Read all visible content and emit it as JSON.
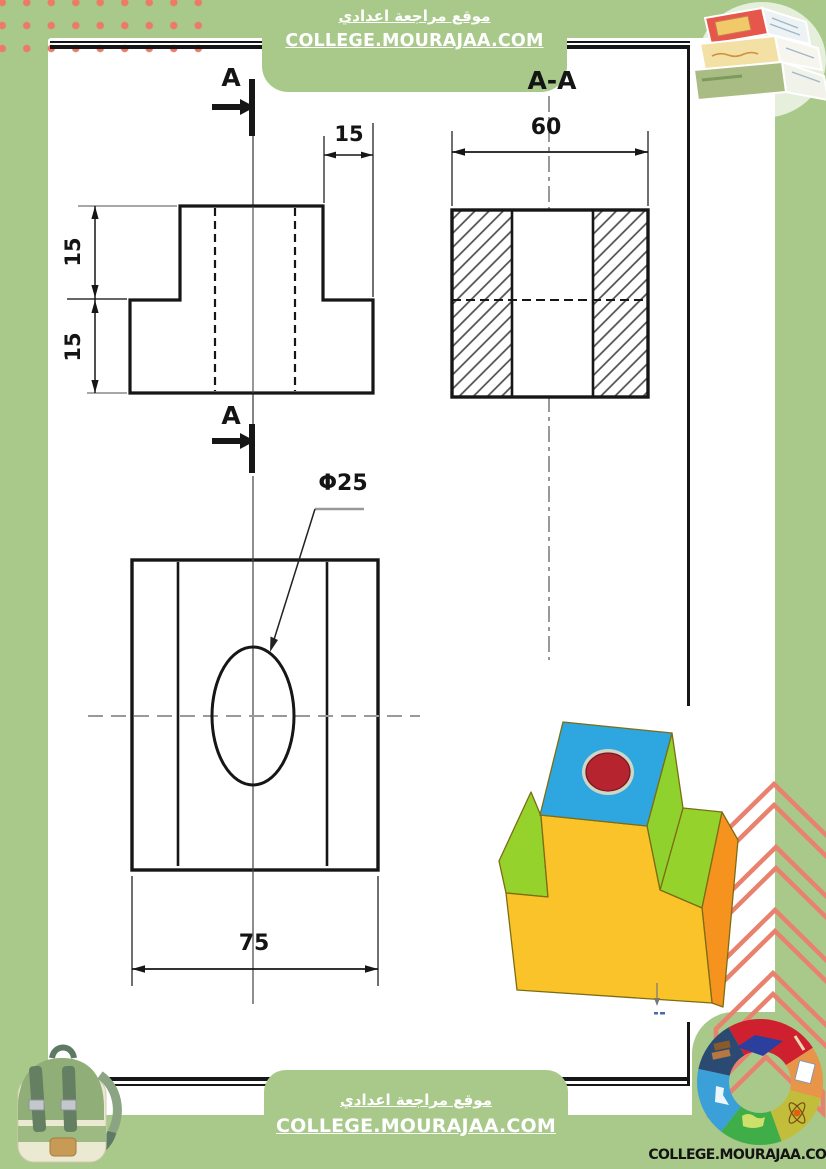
{
  "page": {
    "background_color": "#a8c989",
    "paper_color": "#ffffff",
    "dot_color": "#ec7a67",
    "chevron_color": "#e8826e",
    "line_color": "#161616"
  },
  "header": {
    "site_name_ar": "موقع مراجعة اعدادي",
    "site_url": "COLLEGE.MOURAJAA.COM"
  },
  "footer": {
    "site_name_ar": "موقع مراجعة اعدادي",
    "site_url": "COLLEGE.MOURAJAA.COM"
  },
  "brand_badge": {
    "site_url": "COLLEGE.MOURAJAA.COM"
  },
  "drawing": {
    "front_view": {
      "cut_label_top": "A",
      "cut_label_bottom": "A",
      "dim_tab_width": "15",
      "dim_height_upper": "15",
      "dim_height_lower": "15"
    },
    "section_view": {
      "title": "A-A",
      "dim_depth": "60"
    },
    "top_view": {
      "dim_width": "75",
      "hole_diameter": "Φ25"
    },
    "isometric_view": {
      "front_color": "#fbc32a",
      "side_color": "#f6921e",
      "top_color": "#2ea7e0",
      "step_color": "#95d22c",
      "hole_color": "#b5242f"
    }
  }
}
